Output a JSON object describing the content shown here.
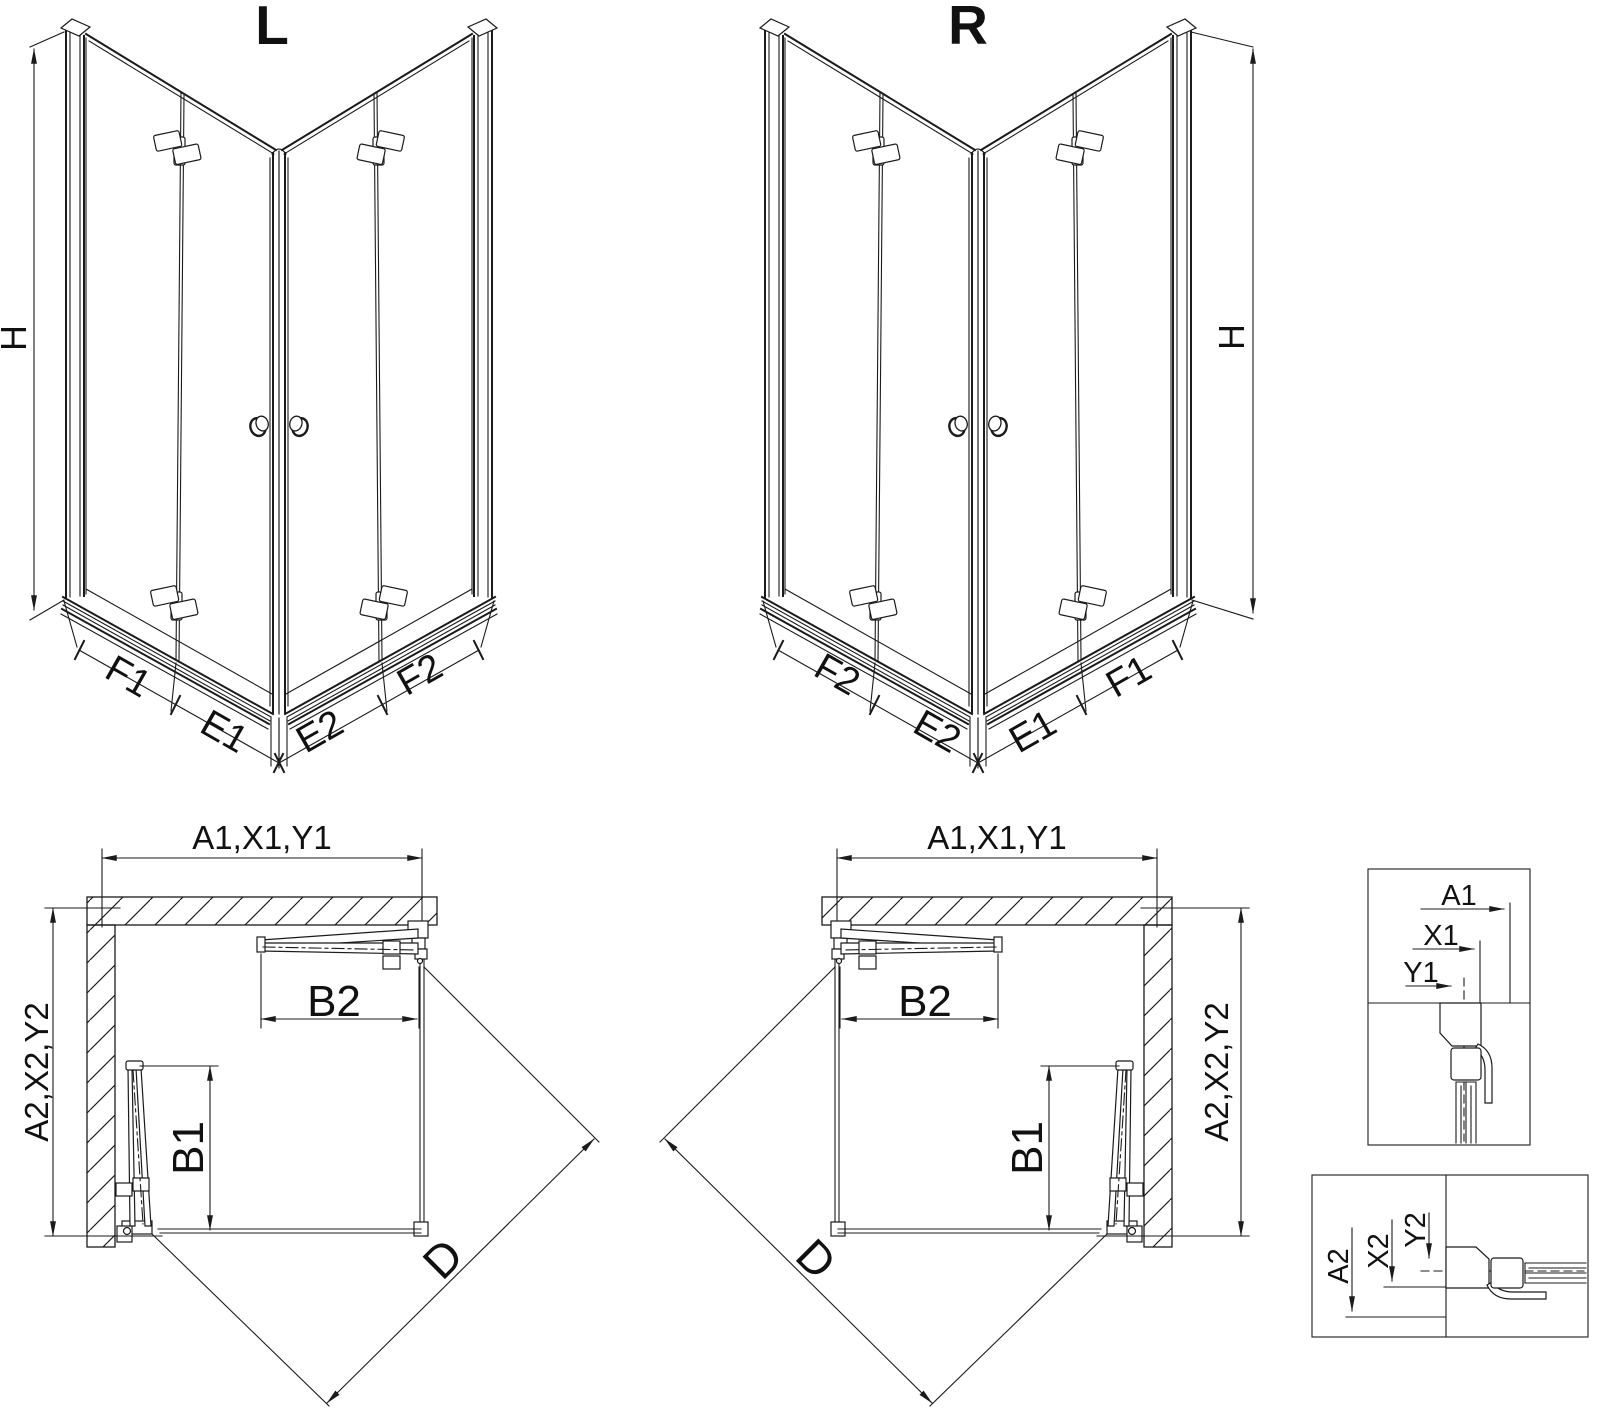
{
  "drawing_l": {
    "title": "L",
    "height_dim": "H",
    "bottom_dims": [
      "F1",
      "E1",
      "E2",
      "F2"
    ]
  },
  "drawing_r": {
    "title": "R",
    "height_dim": "H",
    "bottom_dims": [
      "F2",
      "E2",
      "E1",
      "F1"
    ]
  },
  "plan_left": {
    "width_dim": "A1,X1,Y1",
    "depth_dim": "A2,X2,Y2",
    "door_top_dim": "B2",
    "door_side_dim": "B1",
    "diagonal_dim": "D"
  },
  "plan_right": {
    "width_dim": "A1,X1,Y1",
    "depth_dim": "A2,X2,Y2",
    "door_top_dim": "B2",
    "door_side_dim": "B1",
    "diagonal_dim": "D"
  },
  "detail_box_top": {
    "dims": [
      "A1",
      "X1",
      "Y1"
    ]
  },
  "detail_box_bottom": {
    "dims": [
      "A2",
      "X2",
      "Y2"
    ]
  },
  "colors": {
    "line": "#1b1b1b",
    "text": "#111111",
    "background": "#ffffff"
  }
}
